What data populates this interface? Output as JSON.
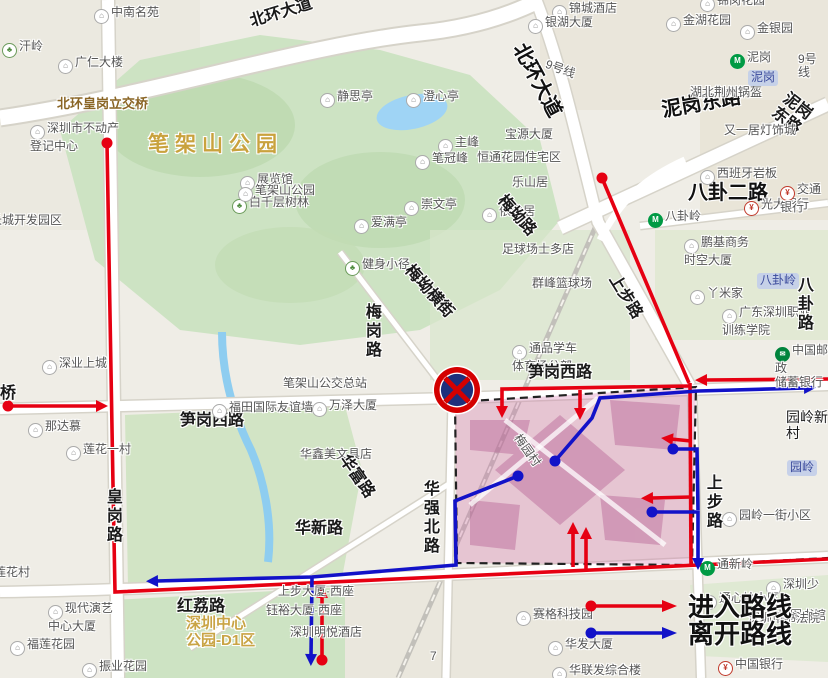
{
  "legend": {
    "enter_label": "进入路线",
    "leave_label": "离开路线",
    "enter_color": "#e60012",
    "leave_color": "#1212c8"
  },
  "no_entry_sign": {
    "cx": 457,
    "cy": 390,
    "r": 23,
    "ring_color": "#d40000",
    "inner_color": "#1d2f7c"
  },
  "zone": {
    "polygon": [
      [
        455,
        402
      ],
      [
        696,
        387
      ],
      [
        692,
        565
      ],
      [
        457,
        563
      ]
    ],
    "extra_border": [
      [
        692,
        565
      ],
      [
        828,
        558
      ]
    ],
    "fill": "#d06aa4",
    "fill_opacity": 0.3,
    "border_color": "#222222"
  },
  "routes": {
    "enter": [
      {
        "dot": [
          107,
          143
        ],
        "pts": [
          [
            107,
            143
          ],
          [
            113,
            485
          ],
          [
            115,
            592
          ],
          [
            828,
            559
          ]
        ]
      },
      {
        "dot": [
          8,
          406
        ],
        "pts": [
          [
            8,
            406
          ],
          [
            98,
            406
          ]
        ],
        "arrow": true
      },
      {
        "dot": [
          322,
          660
        ],
        "pts": [
          [
            322,
            660
          ],
          [
            322,
            596
          ]
        ],
        "arrow": true
      },
      {
        "dot": [
          602,
          178
        ],
        "pts": [
          [
            602,
            178
          ],
          [
            640,
            268
          ],
          [
            689,
            383
          ]
        ]
      },
      {
        "pts": [
          [
            828,
            379
          ],
          [
            705,
            380
          ]
        ],
        "arrow": true
      },
      {
        "pts": [
          [
            690,
            383
          ],
          [
            691,
            566
          ]
        ]
      },
      {
        "pts": [
          [
            691,
            441
          ],
          [
            671,
            439
          ]
        ],
        "arrow": true
      },
      {
        "pts": [
          [
            691,
            497
          ],
          [
            651,
            498
          ]
        ],
        "arrow": true
      },
      {
        "pts": [
          [
            689,
            386
          ],
          [
            502,
            389
          ],
          [
            502,
            408
          ]
        ],
        "arrow": true
      },
      {
        "pts": [
          [
            580,
            390
          ],
          [
            580,
            410
          ]
        ],
        "arrow": true
      },
      {
        "pts": [
          [
            573,
            567
          ],
          [
            573,
            532
          ]
        ],
        "arrow": true
      },
      {
        "pts": [
          [
            586,
            570
          ],
          [
            586,
            537
          ]
        ],
        "arrow": true
      }
    ],
    "leave": [
      {
        "dot": [
          555,
          461
        ],
        "pts": [
          [
            555,
            461
          ],
          [
            592,
            418
          ],
          [
            600,
            398
          ],
          [
            698,
            391
          ],
          [
            806,
            388
          ]
        ],
        "arrow": true
      },
      {
        "dot": [
          518,
          476
        ],
        "pts": [
          [
            518,
            476
          ],
          [
            455,
            501
          ],
          [
            456,
            565
          ],
          [
            312,
            577
          ],
          [
            156,
            581
          ]
        ],
        "arrow": true
      },
      {
        "dot": [
          673,
          449
        ],
        "pts": [
          [
            673,
            449
          ],
          [
            697,
            449
          ],
          [
            698,
            510
          ]
        ]
      },
      {
        "dot": [
          652,
          512
        ],
        "pts": [
          [
            652,
            512
          ],
          [
            698,
            512
          ],
          [
            698,
            560
          ]
        ],
        "arrow": true
      },
      {
        "pts": [
          [
            312,
            578
          ],
          [
            311,
            656
          ]
        ],
        "arrow": true
      }
    ]
  },
  "map": {
    "labels": [
      {
        "t": "中南名苑",
        "x": 94,
        "y": 6,
        "c": "poi",
        "i": "b"
      },
      {
        "t": "汗岭",
        "x": 2,
        "y": 40,
        "c": "poi",
        "i": "park"
      },
      {
        "t": "广仁大楼",
        "x": 58,
        "y": 56,
        "c": "poi",
        "i": "b"
      },
      {
        "t": "北环皇岗立交桥",
        "x": 57,
        "y": 97,
        "c": "bridge"
      },
      {
        "t": "深圳市不动产\n登记中心",
        "x": 30,
        "y": 122,
        "c": "poi2",
        "i": "b"
      },
      {
        "t": "长城开发园区",
        "x": -10,
        "y": 214,
        "c": "poi"
      },
      {
        "t": "展览馆",
        "x": 240,
        "y": 173,
        "c": "poi",
        "i": "b"
      },
      {
        "t": "白千层树林",
        "x": 232,
        "y": 196,
        "c": "poi",
        "i": "park"
      },
      {
        "t": "笔架山公园",
        "x": 148,
        "y": 133,
        "c": "park-lg"
      },
      {
        "t": "静思亭",
        "x": 320,
        "y": 90,
        "c": "poi",
        "i": "b"
      },
      {
        "t": "澄心亭",
        "x": 406,
        "y": 90,
        "c": "poi",
        "i": "b"
      },
      {
        "t": "主峰",
        "x": 438,
        "y": 136,
        "c": "poi",
        "i": "b"
      },
      {
        "t": "笔冠峰",
        "x": 415,
        "y": 152,
        "c": "poi",
        "i": "b"
      },
      {
        "t": "宝源大厦",
        "x": 505,
        "y": 128,
        "c": "poi"
      },
      {
        "t": "恒通花园住宅区",
        "x": 477,
        "y": 151,
        "c": "poi"
      },
      {
        "t": "乐山居",
        "x": 512,
        "y": 176,
        "c": "poi"
      },
      {
        "t": "笔架山公园",
        "x": 238,
        "y": 184,
        "c": "poi",
        "i": "b"
      },
      {
        "t": "崇文亭",
        "x": 404,
        "y": 198,
        "c": "poi",
        "i": "b"
      },
      {
        "t": "爱满亭",
        "x": 354,
        "y": 216,
        "c": "poi",
        "i": "b"
      },
      {
        "t": "健身小径",
        "x": 345,
        "y": 258,
        "c": "poi",
        "i": "park"
      },
      {
        "t": "依山居",
        "x": 482,
        "y": 205,
        "c": "poi",
        "i": "b"
      },
      {
        "t": "足球场士多店",
        "x": 502,
        "y": 243,
        "c": "poi"
      },
      {
        "t": "群峰篮球场",
        "x": 532,
        "y": 277,
        "c": "poi"
      },
      {
        "t": "梅岗路",
        "x": 362,
        "y": 303,
        "c": "rl-v"
      },
      {
        "t": "梅坳路",
        "x": 507,
        "y": 192,
        "c": "rl",
        "r": 48
      },
      {
        "t": "梅坳横街",
        "x": 414,
        "y": 262,
        "c": "rl",
        "r": 48
      },
      {
        "t": "通品学车\n体育场分部",
        "x": 512,
        "y": 342,
        "c": "poi2",
        "i": "b"
      },
      {
        "t": "笋岗西路",
        "x": 528,
        "y": 364,
        "c": "rl"
      },
      {
        "t": "笋岗西路",
        "x": 180,
        "y": 412,
        "c": "rl"
      },
      {
        "t": "福田国际友谊墙",
        "x": 212,
        "y": 401,
        "c": "poi",
        "i": "b"
      },
      {
        "t": "万泽大厦",
        "x": 312,
        "y": 399,
        "c": "poi",
        "i": "b"
      },
      {
        "t": "笔架山公交总站",
        "x": 283,
        "y": 377,
        "c": "poi"
      },
      {
        "t": "华鑫美文具店",
        "x": 300,
        "y": 448,
        "c": "poi"
      },
      {
        "t": "华富路",
        "x": 350,
        "y": 452,
        "c": "rl",
        "r": 55
      },
      {
        "t": "华强北路",
        "x": 420,
        "y": 480,
        "c": "rl-v"
      },
      {
        "t": "华新路",
        "x": 295,
        "y": 520,
        "c": "rl"
      },
      {
        "t": "皇岗路",
        "x": 103,
        "y": 488,
        "c": "rl-v"
      },
      {
        "t": "深业上城",
        "x": 42,
        "y": 357,
        "c": "poi",
        "i": "b"
      },
      {
        "t": "那达慕",
        "x": 28,
        "y": 420,
        "c": "poi",
        "i": "b"
      },
      {
        "t": "莲花一村",
        "x": 66,
        "y": 443,
        "c": "poi",
        "i": "b"
      },
      {
        "t": "莲花村",
        "x": -6,
        "y": 566,
        "c": "poi"
      },
      {
        "t": "现代演艺\n中心大厦",
        "x": 48,
        "y": 602,
        "c": "poi2",
        "i": "b"
      },
      {
        "t": "福莲花园",
        "x": 10,
        "y": 638,
        "c": "poi",
        "i": "b"
      },
      {
        "t": "振业花园",
        "x": 82,
        "y": 660,
        "c": "poi",
        "i": "b"
      },
      {
        "t": "红荔路",
        "x": 177,
        "y": 598,
        "c": "rl"
      },
      {
        "t": "深圳中心\n公园-D1区",
        "x": 186,
        "y": 616,
        "c": "dist"
      },
      {
        "t": "上步大厦·西座",
        "x": 278,
        "y": 585,
        "c": "poi"
      },
      {
        "t": "钰裕大厦·西座",
        "x": 266,
        "y": 604,
        "c": "poi"
      },
      {
        "t": "深圳明悦酒店",
        "x": 290,
        "y": 626,
        "c": "poi"
      },
      {
        "t": "赛格科技园",
        "x": 516,
        "y": 608,
        "c": "poi",
        "i": "b"
      },
      {
        "t": "7",
        "x": 430,
        "y": 650,
        "c": "poi"
      },
      {
        "t": "华联发综合楼",
        "x": 552,
        "y": 664,
        "c": "poi",
        "i": "b"
      },
      {
        "t": "华发大厦",
        "x": 548,
        "y": 638,
        "c": "poi",
        "i": "b"
      },
      {
        "t": "中国银行",
        "x": 718,
        "y": 658,
        "c": "poi",
        "i": "bank"
      },
      {
        "t": "深圳少年\n儿童图书馆",
        "x": 766,
        "y": 578,
        "c": "poi2",
        "i": "b"
      },
      {
        "t": "通心岭小区",
        "x": 702,
        "y": 592,
        "c": "poi",
        "i": "b"
      },
      {
        "t": "深圳市书法院",
        "x": 748,
        "y": 612,
        "c": "poi"
      },
      {
        "t": "园岭一街小区",
        "x": 722,
        "y": 509,
        "c": "poi",
        "i": "b"
      },
      {
        "t": "通新岭",
        "x": 700,
        "y": 558,
        "c": "poi",
        "i": "metro"
      },
      {
        "t": "园岭新村",
        "x": 786,
        "y": 410,
        "c": "rl-sm"
      },
      {
        "t": "园岭",
        "x": 787,
        "y": 460,
        "c": "badge"
      },
      {
        "t": "中国邮政\n储蓄银行",
        "x": 775,
        "y": 344,
        "c": "poi2",
        "i": "post"
      },
      {
        "t": "广东深圳职业\n训练学院",
        "x": 722,
        "y": 306,
        "c": "poi2",
        "i": "b"
      },
      {
        "t": "丫米家",
        "x": 690,
        "y": 287,
        "c": "poi",
        "i": "b"
      },
      {
        "t": "鹏基商务\n时空大厦",
        "x": 684,
        "y": 236,
        "c": "poi2",
        "i": "b"
      },
      {
        "t": "八卦岭",
        "x": 648,
        "y": 210,
        "c": "poi",
        "i": "metro"
      },
      {
        "t": "八卦二路",
        "x": 688,
        "y": 182,
        "c": "rl-lg"
      },
      {
        "t": "西班牙岩板",
        "x": 700,
        "y": 167,
        "c": "poi",
        "i": "b"
      },
      {
        "t": "光大银行",
        "x": 744,
        "y": 198,
        "c": "poi",
        "i": "bank"
      },
      {
        "t": "交通银行",
        "x": 780,
        "y": 183,
        "c": "poi",
        "i": "bank"
      },
      {
        "t": "八卦岭",
        "x": 757,
        "y": 273,
        "c": "badge"
      },
      {
        "t": "八卦路",
        "x": 794,
        "y": 276,
        "c": "rl-v"
      },
      {
        "t": "上步路",
        "x": 620,
        "y": 272,
        "c": "rl",
        "r": 58
      },
      {
        "t": "上步路",
        "x": 703,
        "y": 474,
        "c": "rl-v"
      },
      {
        "t": "泥岗东路",
        "x": 660,
        "y": 100,
        "c": "rl-lg",
        "r": -10
      },
      {
        "t": "泥岗东路",
        "x": 790,
        "y": 90,
        "c": "rl",
        "r": 38
      },
      {
        "t": "湖北荆州锅盔",
        "x": 690,
        "y": 86,
        "c": "poi"
      },
      {
        "t": "又一居灯饰城",
        "x": 724,
        "y": 124,
        "c": "poi"
      },
      {
        "t": "泥岗",
        "x": 730,
        "y": 51,
        "c": "poi",
        "i": "metro"
      },
      {
        "t": "泥岗",
        "x": 748,
        "y": 70,
        "c": "badge"
      },
      {
        "t": "9号线",
        "x": 798,
        "y": 53,
        "c": "poi"
      },
      {
        "t": "9号线",
        "x": 548,
        "y": 58,
        "c": "poi",
        "r": 20
      },
      {
        "t": "锦城酒店",
        "x": 552,
        "y": 2,
        "c": "poi",
        "i": "b"
      },
      {
        "t": "银湖大厦",
        "x": 528,
        "y": 16,
        "c": "poi",
        "i": "b"
      },
      {
        "t": "金湖花园",
        "x": 666,
        "y": 14,
        "c": "poi",
        "i": "b"
      },
      {
        "t": "金银园",
        "x": 740,
        "y": 22,
        "c": "poi",
        "i": "b"
      },
      {
        "t": "锦岗花园",
        "x": 700,
        "y": -6,
        "c": "poi",
        "i": "b"
      },
      {
        "t": "北环大道",
        "x": 248,
        "y": 14,
        "c": "rl",
        "r": -17
      },
      {
        "t": "北环大道",
        "x": 528,
        "y": 40,
        "c": "rl-lg",
        "r": 62
      },
      {
        "t": "桥",
        "x": 0,
        "y": 385,
        "c": "rl"
      },
      {
        "t": "梅园村",
        "x": 522,
        "y": 432,
        "c": "poi",
        "r": 55
      }
    ]
  }
}
